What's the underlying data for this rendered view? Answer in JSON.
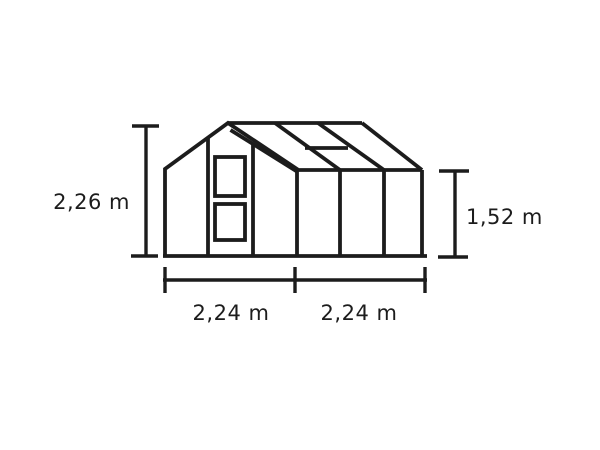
{
  "diagram": {
    "type": "greenhouse-dimension-diagram",
    "ink_color": "#1c1c1c",
    "background_color": "#ffffff",
    "labels": {
      "ridge_height": "2,26 m",
      "eave_height": "1,52 m",
      "gable_width": "2,24 m",
      "side_width": "2,24 m"
    }
  }
}
